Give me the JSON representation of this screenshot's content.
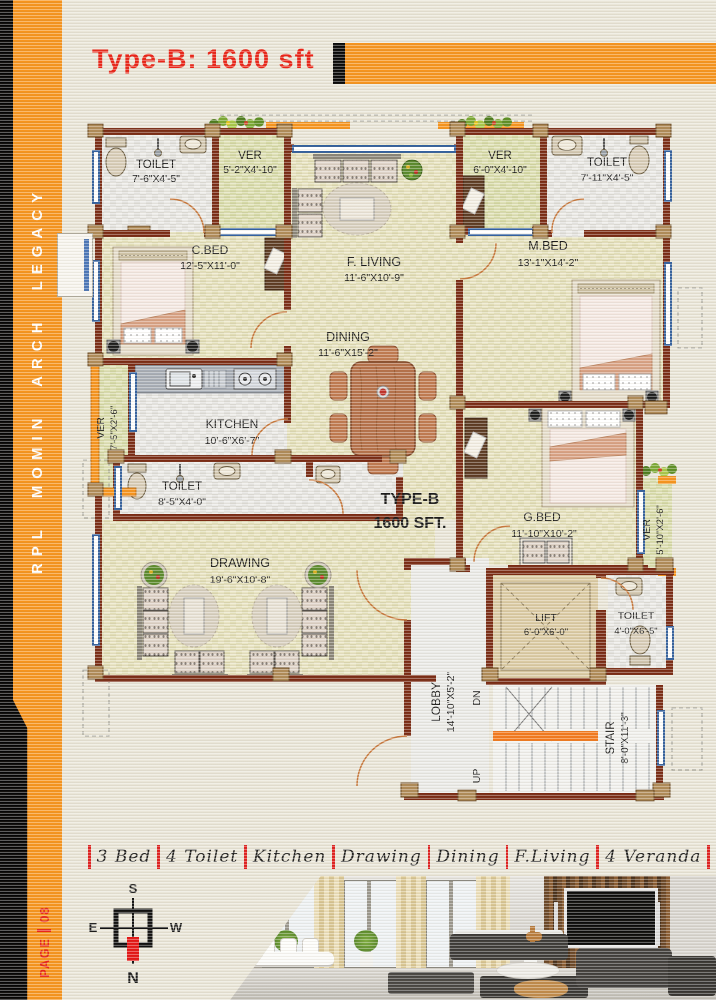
{
  "header": {
    "title": "Type-B: 1600 sft"
  },
  "sidebar": {
    "brand": "RPL MOMIN ARCH LEGACY",
    "page_label": "PAGE",
    "page_number": "08"
  },
  "plan": {
    "type_label": {
      "line1": "TYPE-B",
      "line2": "1600 SFT."
    },
    "rooms": {
      "toilet_tl": {
        "name": "TOILET",
        "dims": "7'-6\"X4'-5\""
      },
      "ver_tl": {
        "name": "VER",
        "dims": "5'-2\"X4'-10\""
      },
      "cbed": {
        "name": "C.BED",
        "dims": "12'-5\"X11'-0\""
      },
      "fliving": {
        "name": "F. LIVING",
        "dims": "11'-6\"X10'-9\""
      },
      "ver_tr": {
        "name": "VER",
        "dims": "6'-0\"X4'-10\""
      },
      "toilet_tr": {
        "name": "TOILET",
        "dims": "7'-11\"X4'-5\""
      },
      "mbed": {
        "name": "M.BED",
        "dims": "13'-1\"X14'-2\""
      },
      "dining": {
        "name": "DINING",
        "dims": "11'-6\"X15'-2\""
      },
      "ver_left": {
        "name": "VER",
        "dims": "7'-5\"X2'-6\""
      },
      "kitchen": {
        "name": "KITCHEN",
        "dims": "10'-6\"X6'-7\""
      },
      "toilet_ml": {
        "name": "TOILET",
        "dims": "8'-5\"X4'-0\""
      },
      "drawing": {
        "name": "DRAWING",
        "dims": "19'-6\"X10'-8\""
      },
      "gbed": {
        "name": "G.BED",
        "dims": "11'-10\"X10'-2\""
      },
      "ver_right": {
        "name": "VER",
        "dims": "5'-10\"X2'-6\""
      },
      "lift": {
        "name": "LIFT",
        "dims": "6'-0\"X6'-0\""
      },
      "toilet_br": {
        "name": "TOILET",
        "dims": "4'-0\"X6'-5\""
      },
      "lobby": {
        "name": "LOBBY",
        "dims": "14'-10\"X5'-2\""
      },
      "stair": {
        "name": "STAIR",
        "dims": "8'-0\"X11'-3\""
      }
    },
    "stair_labels": {
      "dn": "DN",
      "up": "UP"
    }
  },
  "legend": {
    "items": [
      "3 Bed",
      "4 Toilet",
      "Kitchen",
      "Drawing",
      "Dining",
      "F.Living",
      "4 Veranda"
    ]
  },
  "compass": {
    "north": "N",
    "south": "S",
    "east": "E",
    "west": "W"
  },
  "colors": {
    "accent_orange": "#F7941D",
    "title_red": "#EA2418",
    "wall_brown": "#7A2B14",
    "type_label_red": "#9C1B21",
    "legend_separator_red": "#E02020"
  }
}
